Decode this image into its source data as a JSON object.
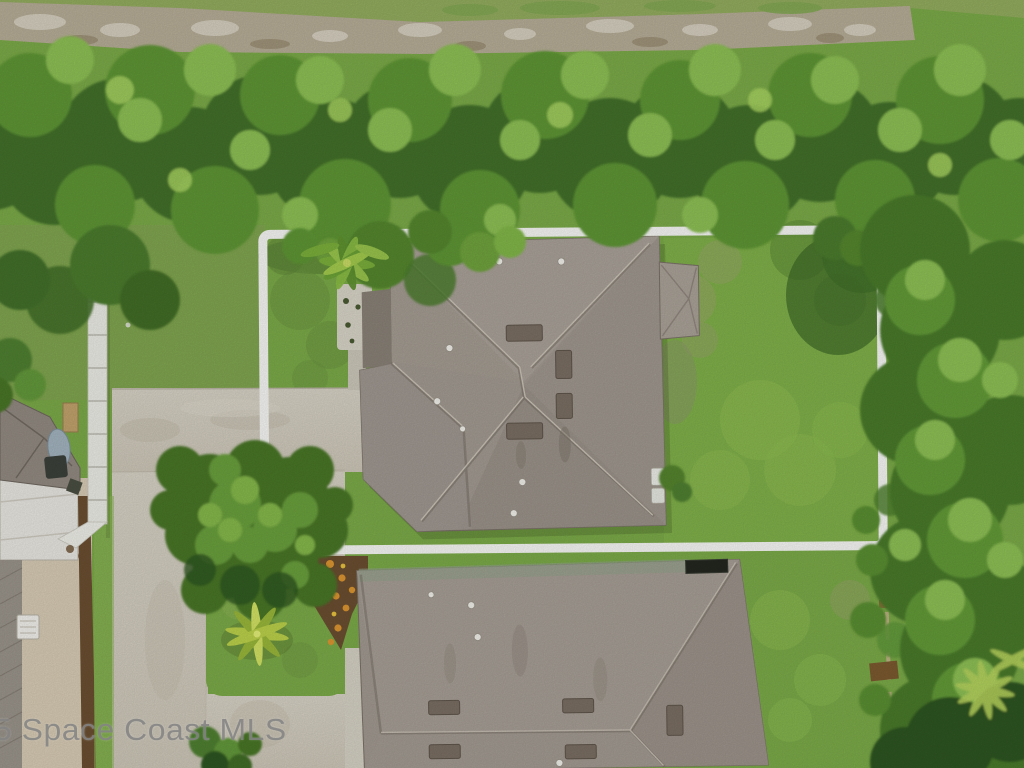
{
  "watermark": {
    "text": "5 Space Coast MLS"
  },
  "palette": {
    "boundary_white": "#f8f9f6",
    "watermark_gray": "#858585",
    "lawn_green": "#7cab49",
    "backyard_green": "#83b24a",
    "canopy_green": "#5f9636",
    "canopy_dark": "#42702a",
    "canopy_light": "#8ec155",
    "roof_main_gray": "#a39b92",
    "roof_bottom_gray": "#a29a91",
    "roof_dark_plane": "#8a8278",
    "vent_brown": "#7b6f63",
    "panel_black": "#23271f",
    "driveway_concrete": "#d3cec0",
    "entry_pad": "#d9d5c8",
    "dirt_trail_tan": "#b7ae97",
    "mulch_brown": "#6b4f31",
    "flower_orange": "#dd9631",
    "fence_tan": "#c8b68d",
    "pole_white": "#edede7",
    "neighbor_beige": "#d8ccb5",
    "neighbor_white_roof": "#eae8e2"
  }
}
